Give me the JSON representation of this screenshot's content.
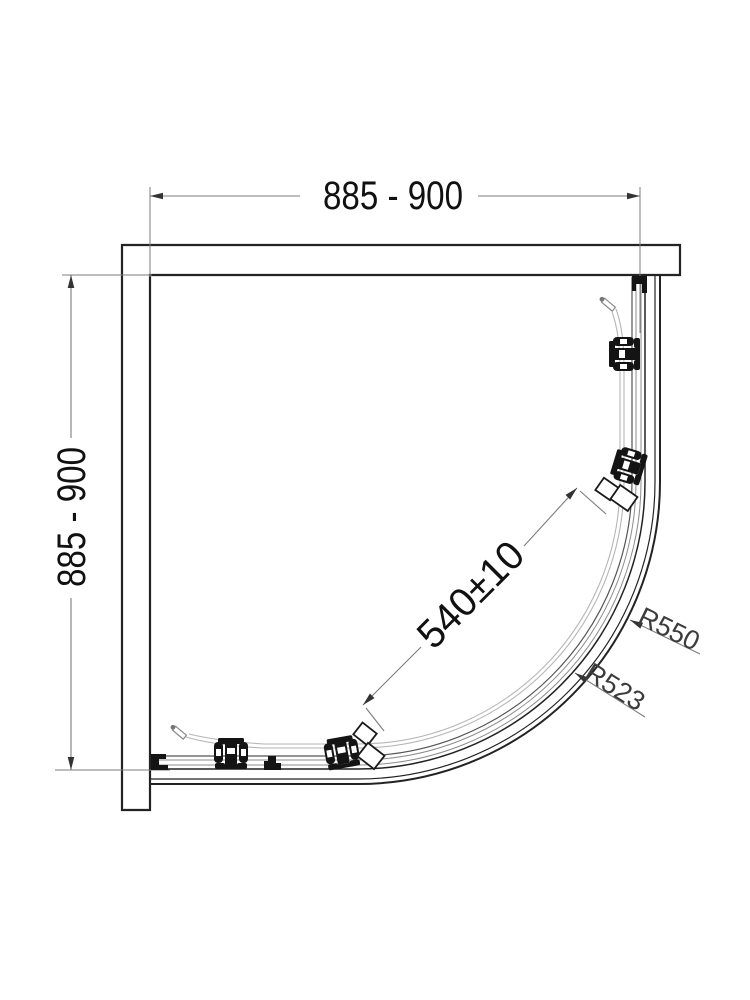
{
  "drawing": {
    "background": "#ffffff",
    "labels": {
      "top_width": "885 - 900",
      "left_depth": "885 - 900",
      "diagonal_opening": "540±10",
      "outer_radius": "R550",
      "inner_radius": "R523"
    },
    "colors": {
      "outline": "#232323",
      "dimension_lines": "#7d7d7d",
      "glass_lines": "#b6b6b6",
      "hardware": "#141414",
      "dimension_text": "#111111",
      "radius_text": "#3c3c3c"
    }
  }
}
